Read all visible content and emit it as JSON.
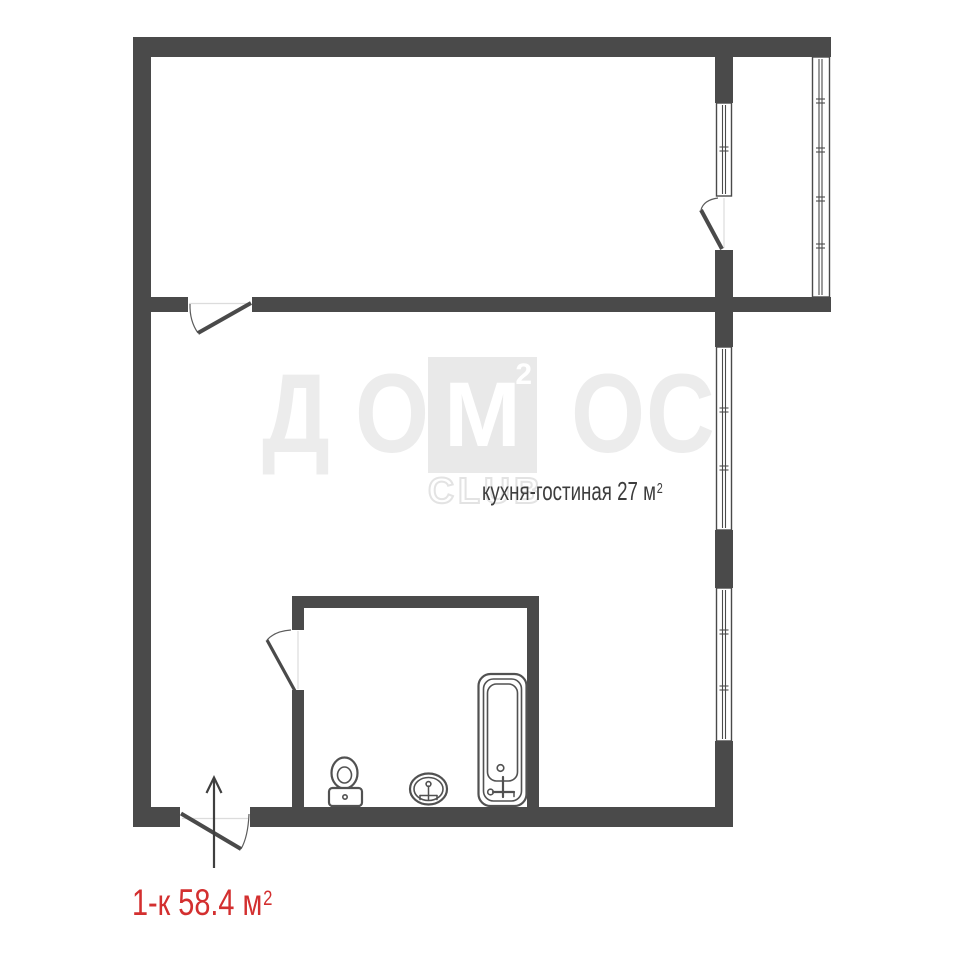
{
  "plan": {
    "type": "apartment-floor-plan",
    "room_label": {
      "text": "кухня-гостиная 27 м",
      "sup": "2"
    },
    "apartment_label": {
      "text": "1-к 58.4 м",
      "sup": "2"
    }
  },
  "watermark": {
    "letter_d": "Д",
    "letter_o1": "О",
    "letter_m": "М",
    "m_sup": "2",
    "letter_o2": "О",
    "letter_s": "С",
    "club": "CLUB"
  },
  "colors": {
    "wall": "#4a4a4a",
    "line": "#4a4a4a",
    "fixture": "#515151",
    "accent": "#d32f2f",
    "label": "#3d3d3d",
    "wm_letter": "#ececec",
    "wm_square": "#e9e9e9",
    "threshold": "#dcdcdc",
    "arrow": "#3f3f3f"
  }
}
